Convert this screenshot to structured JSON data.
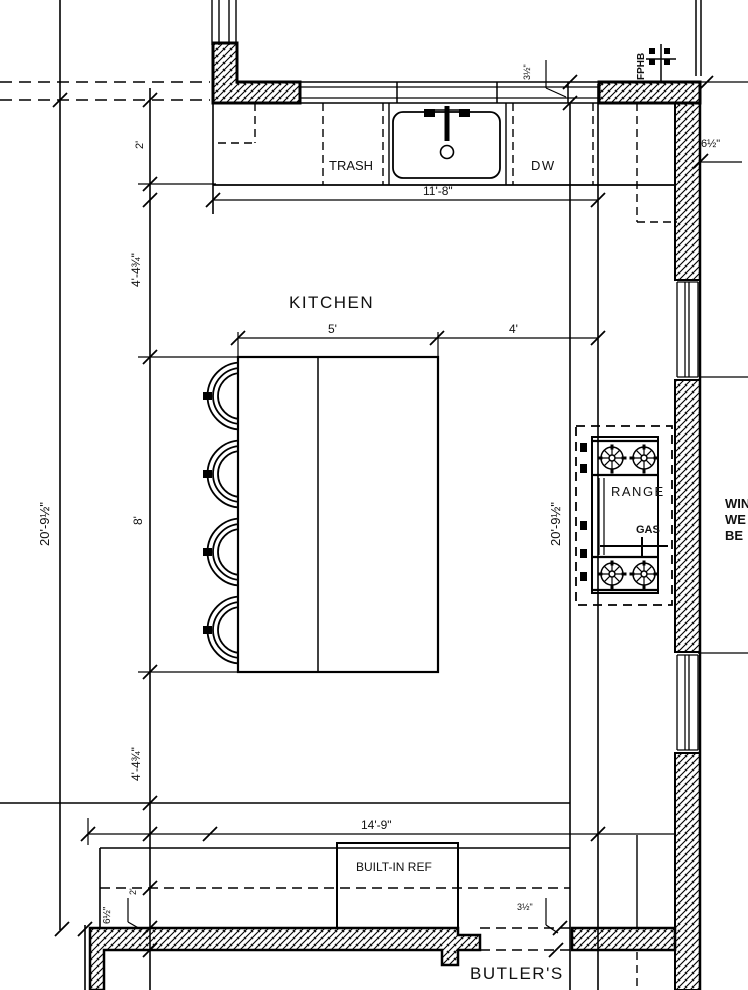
{
  "labels": {
    "kitchen": "KITCHEN",
    "butlers": "BUTLER'S",
    "trash": "TRASH",
    "dw": "DW",
    "range": "RANGE",
    "gas": "GAS",
    "built_in_ref": "BUILT-IN REF",
    "fphb": "FPHB",
    "clipped_right_1": "WIN",
    "clipped_right_2": "WE",
    "clipped_right_3": "BE"
  },
  "dims": {
    "counter_run": "11'-8\"",
    "counter_depth": "2'",
    "island_width": "5'",
    "island_gap": "4'",
    "island_length": "8'",
    "offset_top": "4'-4¾\"",
    "offset_bottom": "4'-4¾\"",
    "room_left": "20'-9½\"",
    "room_mid": "20'-9½\"",
    "bottom_run": "14'-9\"",
    "wall_top_right": "6½\"",
    "wall_bottom_left": "6½\"",
    "wall_top": "3½\"",
    "wall_bottom": "3½\"",
    "bottom_depth": "2'"
  },
  "colors": {
    "line": "#000000",
    "background": "#ffffff"
  }
}
